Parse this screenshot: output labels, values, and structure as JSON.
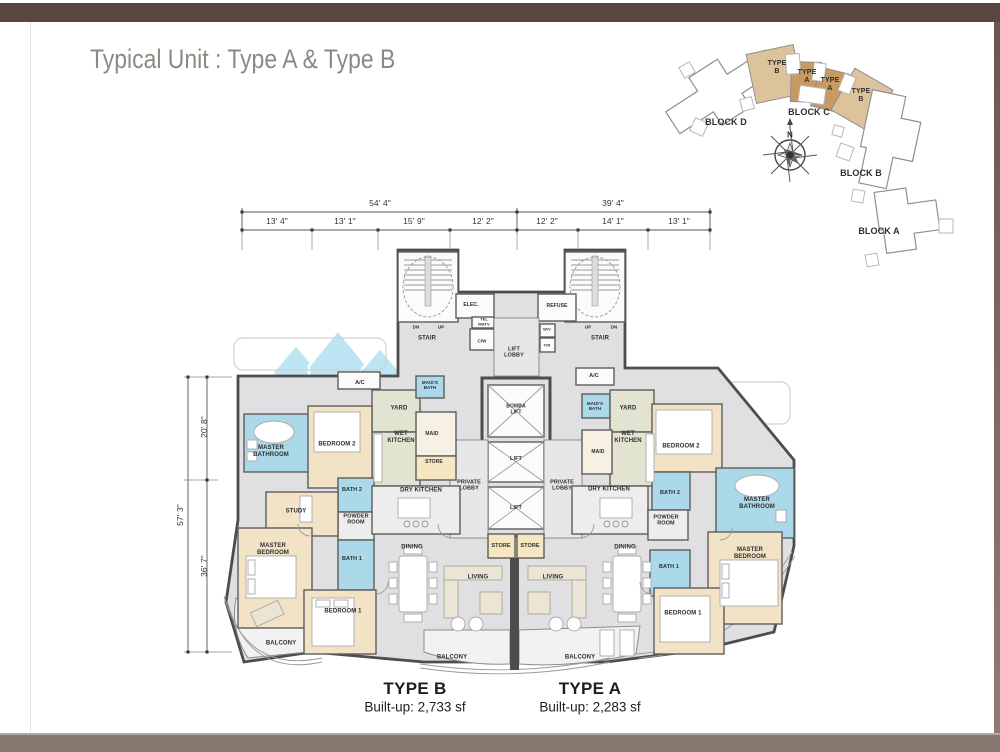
{
  "palette": {
    "frame_top": "#594640",
    "frame_bottom": "#87786f",
    "frame_bottom_highlight": "#b4a79e",
    "title_gray": "#8e8882",
    "wall_dark": "#4d4d4d",
    "floor_gray": "#e0e0e3",
    "bedroom_tan": "#f2e3c6",
    "bath_blue": "#abd9e9",
    "kitchen_green": "#e2e3d0",
    "store_tan": "#f6e6c2",
    "keyplan_tan_light": "#dcc39c",
    "keyplan_tan_dark": "#c69a62",
    "watermark_blue": "#7fcdea"
  },
  "header": {
    "title": "Typical Unit : Type A & Type B"
  },
  "unit_summary": [
    {
      "name": "TYPE B",
      "builtup": "Built-up: 2,733 sf"
    },
    {
      "name": "TYPE A",
      "builtup": "Built-up: 2,283 sf"
    }
  ],
  "dimension_labels": [
    {
      "n": "dim-top-54-4",
      "t": "54' 4\"",
      "x": 380,
      "y": 204,
      "s": 8.5
    },
    {
      "n": "dim-top-39-4",
      "t": "39' 4\"",
      "x": 613,
      "y": 204,
      "s": 8.5
    },
    {
      "n": "dim-seg-13-4",
      "t": "13' 4\"",
      "x": 277,
      "y": 222,
      "s": 8.5
    },
    {
      "n": "dim-seg-13-1a",
      "t": "13' 1\"",
      "x": 345,
      "y": 222,
      "s": 8.5
    },
    {
      "n": "dim-seg-15-9",
      "t": "15' 9\"",
      "x": 414,
      "y": 222,
      "s": 8.5
    },
    {
      "n": "dim-seg-12-2a",
      "t": "12' 2\"",
      "x": 483,
      "y": 222,
      "s": 8.5
    },
    {
      "n": "dim-seg-12-2b",
      "t": "12' 2\"",
      "x": 547,
      "y": 222,
      "s": 8.5
    },
    {
      "n": "dim-seg-14-1",
      "t": "14' 1\"",
      "x": 613,
      "y": 222,
      "s": 8.5
    },
    {
      "n": "dim-seg-13-1b",
      "t": "13' 1\"",
      "x": 679,
      "y": 222,
      "s": 8.5
    },
    {
      "n": "dim-left-57-3",
      "t": "57' 3\"",
      "x": 181,
      "y": 515,
      "s": 8.5,
      "r": -90
    },
    {
      "n": "dim-left-20-8",
      "t": "20' 8\"",
      "x": 205,
      "y": 427,
      "s": 8.5,
      "r": -90
    },
    {
      "n": "dim-left-36-7",
      "t": "36' 7\"",
      "x": 205,
      "y": 566,
      "s": 8.5,
      "r": -90
    }
  ],
  "keyplan_labels": [
    {
      "n": "keyplan-unit-type-b-1",
      "t": "TYPE B",
      "x": 777,
      "y": 68,
      "w": 24,
      "s": 7
    },
    {
      "n": "keyplan-unit-type-a-1",
      "t": "TYPE A",
      "x": 807,
      "y": 77,
      "w": 24,
      "s": 7
    },
    {
      "n": "keyplan-unit-type-a-2",
      "t": "TYPE A",
      "x": 830,
      "y": 85,
      "w": 24,
      "s": 7
    },
    {
      "n": "keyplan-unit-type-b-2",
      "t": "TYPE B",
      "x": 861,
      "y": 96,
      "w": 24,
      "s": 7
    },
    {
      "n": "keyplan-block-d",
      "t": "BLOCK D",
      "x": 726,
      "y": 122,
      "s": 9
    },
    {
      "n": "keyplan-block-c",
      "t": "BLOCK C",
      "x": 809,
      "y": 112,
      "s": 9
    },
    {
      "n": "keyplan-block-b",
      "t": "BLOCK B",
      "x": 861,
      "y": 173,
      "s": 9
    },
    {
      "n": "keyplan-block-a",
      "t": "BLOCK A",
      "x": 879,
      "y": 231,
      "s": 9
    },
    {
      "n": "compass-north-label",
      "t": "N",
      "x": 790,
      "y": 135,
      "s": 8
    }
  ],
  "room_labels": [
    {
      "n": "room-ac-left",
      "t": "A/C",
      "x": 360,
      "y": 383,
      "s": 5.5
    },
    {
      "n": "room-master-bathroom-left",
      "t": "MASTER BATHROOM",
      "x": 271,
      "y": 452,
      "w": 42,
      "s": 6
    },
    {
      "n": "room-bedroom2-left",
      "t": "BEDROOM 2",
      "x": 337,
      "y": 445,
      "s": 6
    },
    {
      "n": "room-yard-left",
      "t": "YARD",
      "x": 399,
      "y": 409,
      "s": 6
    },
    {
      "n": "room-maids-bath-left",
      "t": "MAID'S BATH",
      "x": 430,
      "y": 385,
      "w": 28,
      "s": 4.5
    },
    {
      "n": "room-wet-kitchen-left",
      "t": "WET KITCHEN",
      "x": 401,
      "y": 438,
      "w": 36,
      "s": 6
    },
    {
      "n": "room-maid-left",
      "t": "MAID",
      "x": 432,
      "y": 435,
      "s": 5
    },
    {
      "n": "room-store-left",
      "t": "STORE",
      "x": 434,
      "y": 463,
      "s": 5
    },
    {
      "n": "room-bath2-left",
      "t": "BATH 2",
      "x": 352,
      "y": 490,
      "s": 5.5
    },
    {
      "n": "room-powder-room-left",
      "t": "POWDER ROOM",
      "x": 356,
      "y": 520,
      "w": 34,
      "s": 5.5
    },
    {
      "n": "room-study-left",
      "t": "STUDY",
      "x": 296,
      "y": 512,
      "s": 6
    },
    {
      "n": "room-master-bedroom-left",
      "t": "MASTER BEDROOM",
      "x": 273,
      "y": 550,
      "w": 42,
      "s": 6
    },
    {
      "n": "room-bath1-left",
      "t": "BATH 1",
      "x": 352,
      "y": 559,
      "s": 5.5
    },
    {
      "n": "room-bedroom1-left",
      "t": "BEDROOM 1",
      "x": 343,
      "y": 612,
      "s": 6
    },
    {
      "n": "room-dry-kitchen-left",
      "t": "DRY KITCHEN",
      "x": 421,
      "y": 491,
      "s": 6
    },
    {
      "n": "room-dining-left",
      "t": "DINING",
      "x": 412,
      "y": 548,
      "s": 6
    },
    {
      "n": "room-balcony-left",
      "t": "BALCONY",
      "x": 281,
      "y": 644,
      "s": 6
    },
    {
      "n": "room-living-left",
      "t": "LIVING",
      "x": 478,
      "y": 578,
      "s": 6
    },
    {
      "n": "room-balcony-center-left",
      "t": "BALCONY",
      "x": 452,
      "y": 658,
      "s": 6
    },
    {
      "n": "room-stair-left",
      "t": "STAIR",
      "x": 427,
      "y": 339,
      "s": 6
    },
    {
      "n": "room-dn-left",
      "t": "DN",
      "x": 416,
      "y": 327,
      "s": 4.5
    },
    {
      "n": "room-up-left",
      "t": "UP",
      "x": 441,
      "y": 327,
      "s": 4.5
    },
    {
      "n": "room-elec",
      "t": "ELEC.",
      "x": 471,
      "y": 306,
      "s": 5
    },
    {
      "n": "room-tel-matv",
      "t": "TEL MATV",
      "x": 484,
      "y": 322,
      "w": 18,
      "s": 4
    },
    {
      "n": "room-cw",
      "t": "C/W",
      "x": 482,
      "y": 341,
      "s": 4.5
    },
    {
      "n": "room-lift-lobby",
      "t": "LIFT LOBBY",
      "x": 514,
      "y": 353,
      "w": 24,
      "s": 5.5
    },
    {
      "n": "room-refuse",
      "t": "REFUSE",
      "x": 557,
      "y": 307,
      "s": 5
    },
    {
      "n": "room-wv",
      "t": "W/V",
      "x": 547,
      "y": 330,
      "s": 4
    },
    {
      "n": "room-tr",
      "t": "T/R",
      "x": 547,
      "y": 346,
      "s": 4
    },
    {
      "n": "room-up-right",
      "t": "UP",
      "x": 588,
      "y": 327,
      "s": 4.5
    },
    {
      "n": "room-dn-right",
      "t": "DN",
      "x": 614,
      "y": 327,
      "s": 4.5
    },
    {
      "n": "room-stair-right",
      "t": "STAIR",
      "x": 600,
      "y": 339,
      "s": 6
    },
    {
      "n": "room-bomba-lift",
      "t": "BOMBA LIFT",
      "x": 516,
      "y": 410,
      "w": 30,
      "s": 5
    },
    {
      "n": "room-lift-1",
      "t": "LIFT",
      "x": 516,
      "y": 459,
      "s": 5.5
    },
    {
      "n": "room-lift-2",
      "t": "LIFT",
      "x": 516,
      "y": 508,
      "s": 5.5
    },
    {
      "n": "room-private-lobby-left",
      "t": "PRIVATE LOBBY",
      "x": 469,
      "y": 486,
      "w": 34,
      "s": 5.5
    },
    {
      "n": "room-private-lobby-right",
      "t": "PRIVATE LOBBY",
      "x": 562,
      "y": 486,
      "w": 34,
      "s": 5.5
    },
    {
      "n": "room-store-center-1",
      "t": "STORE",
      "x": 501,
      "y": 546,
      "s": 5.5
    },
    {
      "n": "room-store-center-2",
      "t": "STORE",
      "x": 530,
      "y": 546,
      "s": 5.5
    },
    {
      "n": "room-ac-right",
      "t": "A/C",
      "x": 594,
      "y": 376,
      "s": 5.5
    },
    {
      "n": "room-maids-bath-right",
      "t": "MAID'S BATH",
      "x": 595,
      "y": 406,
      "w": 28,
      "s": 4.5
    },
    {
      "n": "room-yard-right",
      "t": "YARD",
      "x": 628,
      "y": 409,
      "s": 6
    },
    {
      "n": "room-wet-kitchen-right",
      "t": "WET KITCHEN",
      "x": 628,
      "y": 438,
      "w": 36,
      "s": 6
    },
    {
      "n": "room-maid-right",
      "t": "MAID",
      "x": 598,
      "y": 453,
      "s": 5
    },
    {
      "n": "room-bedroom2-right",
      "t": "BEDROOM 2",
      "x": 681,
      "y": 447,
      "s": 6
    },
    {
      "n": "room-dry-kitchen-right",
      "t": "DRY KITCHEN",
      "x": 609,
      "y": 490,
      "s": 6
    },
    {
      "n": "room-bath2-right",
      "t": "BATH 2",
      "x": 670,
      "y": 493,
      "s": 5.5
    },
    {
      "n": "room-powder-room-right",
      "t": "POWDER ROOM",
      "x": 666,
      "y": 521,
      "w": 34,
      "s": 5.5
    },
    {
      "n": "room-master-bathroom-right",
      "t": "MASTER BATHROOM",
      "x": 757,
      "y": 504,
      "w": 44,
      "s": 6
    },
    {
      "n": "room-bath1-right",
      "t": "BATH 1",
      "x": 669,
      "y": 567,
      "s": 5.5
    },
    {
      "n": "room-master-bedroom-right",
      "t": "MASTER BEDROOM",
      "x": 750,
      "y": 554,
      "w": 44,
      "s": 6
    },
    {
      "n": "room-bedroom1-right",
      "t": "BEDROOM 1",
      "x": 683,
      "y": 614,
      "s": 6
    },
    {
      "n": "room-dining-right",
      "t": "DINING",
      "x": 625,
      "y": 548,
      "s": 6
    },
    {
      "n": "room-living-right",
      "t": "LIVING",
      "x": 553,
      "y": 578,
      "s": 6
    },
    {
      "n": "room-balcony-center-right",
      "t": "BALCONY",
      "x": 580,
      "y": 658,
      "s": 6
    }
  ]
}
